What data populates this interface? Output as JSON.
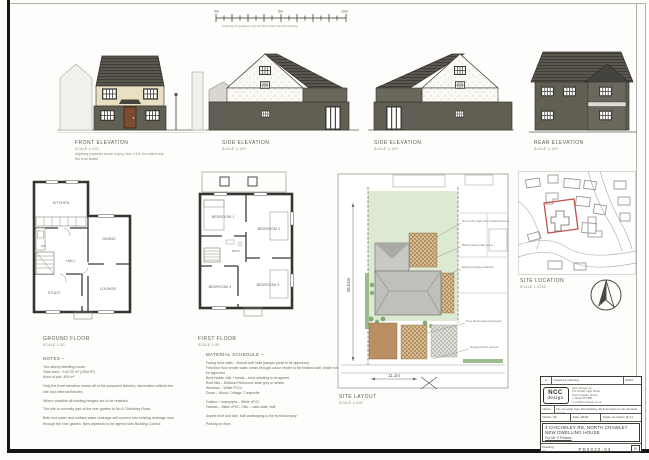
{
  "scale_bar": {
    "zero": "0m",
    "mid": "5m",
    "end": "10m",
    "caption": "Scale bar for guidance only. DO NOT scale from this drawing."
  },
  "elevations": {
    "front": {
      "title": "FRONT ELEVATION",
      "scale": "SCALE 1:100",
      "note1": "Adjoining properties shown in grey, Nos. 2 & 6, for context only",
      "note2": "Not to be scaled"
    },
    "side1": {
      "title": "SIDE ELEVATION",
      "scale": "SCALE 1:100"
    },
    "side2": {
      "title": "SIDE ELEVATION",
      "scale": "SCALE 1:100"
    },
    "rear": {
      "title": "REAR ELEVATION",
      "scale": "SCALE 1:100"
    }
  },
  "ground_floor": {
    "title": "GROUND FLOOR",
    "scale": "SCALE 1:50",
    "rooms": {
      "kitchen": "KITCHEN",
      "dining": "DINING",
      "hall": "HALL",
      "study": "STUDY",
      "lounge": "LOUNGE",
      "wc": "WC"
    }
  },
  "first_floor": {
    "title": "FIRST FLOOR",
    "scale": "SCALE 1:50",
    "rooms": {
      "bed1": "BEDROOM 1",
      "bed2": "BEDROOM 2",
      "bed3": "BEDROOM 3",
      "bed4": "BEDROOM 4",
      "bath": "BATH"
    }
  },
  "notes": {
    "title": "NOTES –",
    "lines": [
      "Two storey dwelling house.",
      "Total area: ~140.00 m² (1500 ft²)",
      "Area of plot: 400 m²",
      "Only the front elevation shows all of the proposed finishes; information reflects the site and external finishes.",
      "Where possible all existing hedges are to be retained.",
      "The site is currently part of the rear garden to No.4 Chicheley Road.",
      "Both foul water and surface water drainage will connect into existing drainage runs through the rear garden. New pipework to be agreed with Building Control."
    ]
  },
  "materials": {
    "title": "MATERIAL SCHEDULE –",
    "lines": [
      "Facing brick walls – Ibstock buff multi (sample panel to be approved)",
      "First floor front render walls: cream through-colour render to the finished wall, render whitewash to be approved",
      "Brick heads, cills + bands – brick detailing to be agreed",
      "Roof tiles – Redland Richmond, slate grey or similar",
      "Windows – White PVCu",
      "Doors – Wood, Cottage, Composite",
      "Gutters + downpipes – White uPVC",
      "Fascias – Black uPVC. Cills – rustic slate, buff",
      "Aspect front and side, buff landscaping to the front boundary.",
      "Parking on drive."
    ]
  },
  "site_layout": {
    "title": "SITE LAYOUT",
    "scale": "SCALE 1:200",
    "dim_height": "28.04m",
    "dim_width": "11.1m",
    "annotations": [
      "New 1.8m high close boarded fence",
      "Block paved patio area",
      "Existing hedge retained",
      "New block paved driveway",
      "Dropped kerb access"
    ]
  },
  "site_location": {
    "title": "SITE LOCATION",
    "scale": "SCALE 1:1250"
  },
  "title_block": {
    "revision": {
      "rev": "A",
      "description": "Issued for planning",
      "date": "06/20"
    },
    "logo_top": "NCC",
    "logo_bottom": "design",
    "address": [
      "NCC Design Ltd",
      "The Studio, High Street",
      "North Crawley, Bucks",
      "t: 01234 567 890",
      "e: info@nccdesign.co.uk"
    ],
    "notes_label": "Notes:",
    "notes_text": "Do not scale from this drawing. All dimensions to be checked on site.",
    "drawn_label": "Drawn:",
    "drawn_value": "NC",
    "date_label": "Date:",
    "date_value": "06/20",
    "scale_label": "Scale:",
    "scale_value": "As shown @ A1",
    "project_line1": "4 CHICHELEY RD, NORTH CRAWLEY",
    "project_line2": "NEW DWELLING HOUSE",
    "project_line3": "For Mr C Pearce",
    "number_label": "Drawing No:",
    "number_value": "PD5020-03",
    "rev_box": "B"
  }
}
